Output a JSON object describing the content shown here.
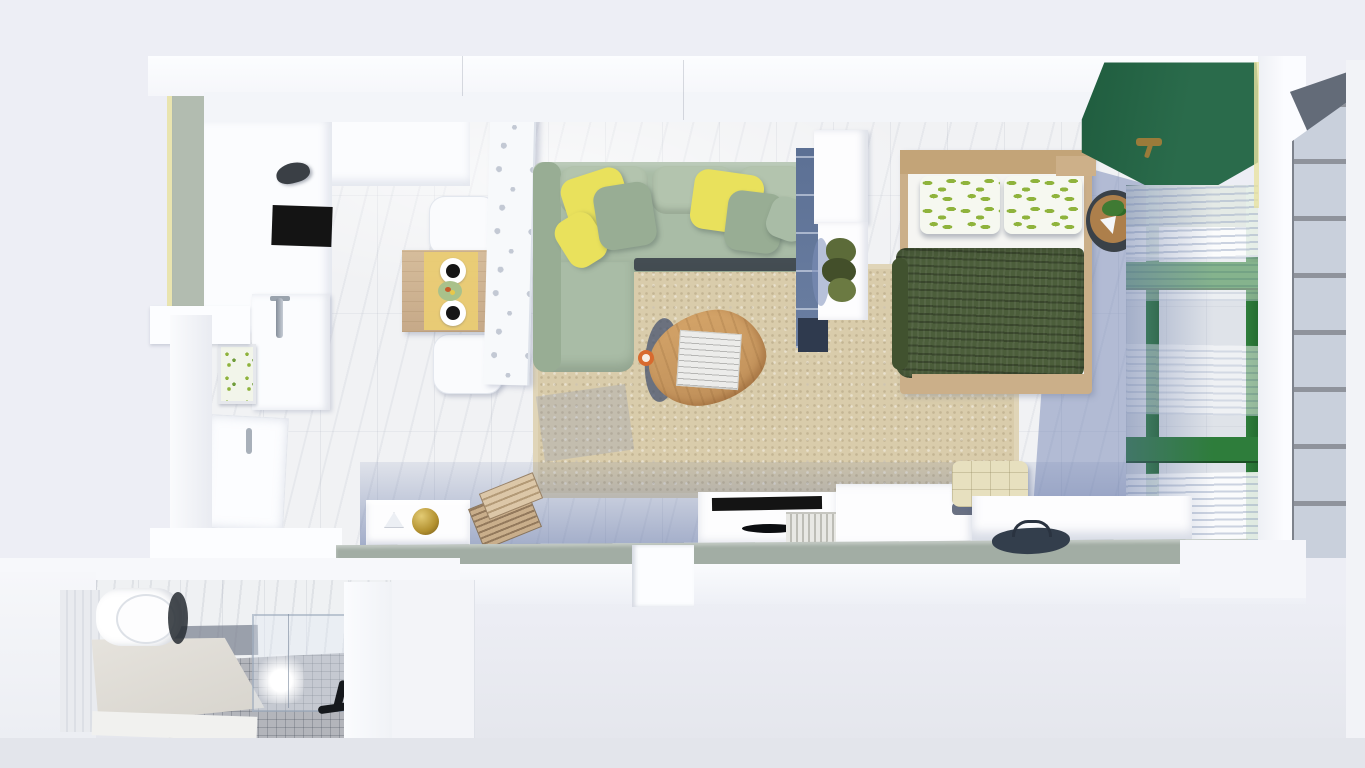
{
  "meta": {
    "title": "3D top-down floor plan render of a studio apartment",
    "width_px": 1365,
    "height_px": 768,
    "view": "top-down-3d-render",
    "visible_text": ""
  },
  "colors": {
    "bg_outer": "#edeef5",
    "bg_bottom": "#e3e5eb",
    "wall_white": "#fcfdff",
    "wall_face": "#f3f5f9",
    "sage_wall": "#b2bcb0",
    "bottom_sage": "#a2ada4",
    "sun_edge": "#e8e2a2",
    "marble_base": "#f1f2f4",
    "counter_white": "#fbfcfe",
    "cooktop_black": "#141414",
    "runner_yellow": "#eacc74",
    "plate_dark": "#161616",
    "bowl_green": "#a9c18b",
    "chair_white": "#fafbfd",
    "divider_white": "#f7f9fb",
    "divider_hole": "#c3c9d4",
    "sofa_green": "#a9bca6",
    "sofa_dark": "#98ad94",
    "cushion_light": "#b3c4ae",
    "pillow_yellow": "#e9e15c",
    "seat_shadow": "#343b45",
    "rug_beige": "#d9ccab",
    "rug_edge": "#e0d5b8",
    "coffee_wood": "#c0905a",
    "coffee_shadow": "#46536f",
    "book_gray": "#ececea",
    "cup_orange": "#d86a2e",
    "shelf_blue": "#5c7094",
    "shelf_dark": "#2f3a4e",
    "console_white": "#fdfdfe",
    "plant_olive": "#5c6b39",
    "bed_wood": "#cbaf89",
    "mattress_white": "#f5f5f2",
    "blanket_green": "#4c5e3b",
    "leaf_green": "#8fb33c",
    "pillow_white": "#f6f8f0",
    "green_wall": "#2a6b4b",
    "brass": "#9a7b3a",
    "window_green": "#2e7d3b",
    "window_dark": "#1d4a2c",
    "curtain_stripe": "#c9d1df",
    "shadow_blue": "#7d90ba",
    "facade_glass": "#c9d0dc",
    "facade_mullion": "#8f939c",
    "facade_dark": "#636b78",
    "gold": "#b2902f",
    "ottoman_cream": "#e7e0bf",
    "bag_dark": "#333e4c",
    "bath_floor": "#b3b5bb",
    "bath_platform": "#d6d3cc",
    "fixture_dark": "#16191d",
    "glass_tint": "rgba(225,235,245,0.38)"
  },
  "scene": {
    "rooms": [
      {
        "name": "kitchen-dining",
        "position": "top-left"
      },
      {
        "name": "living-room",
        "position": "center"
      },
      {
        "name": "bedroom",
        "position": "right"
      },
      {
        "name": "bathroom",
        "position": "bottom-left"
      }
    ],
    "objects": [
      "kitchen-counter-l-shape",
      "cooktop",
      "range-hood",
      "kettle",
      "dining-table",
      "table-runner",
      "plates",
      "fruit-bowl",
      "dining-chairs",
      "perforated-room-divider",
      "sink-cabinet",
      "faucet",
      "botanical-art-frame",
      "entry-door",
      "sectional-sofa",
      "yellow-throw-pillows",
      "sage-throw-pillows",
      "area-rug",
      "oval-coffee-table",
      "open-book",
      "coffee-cup",
      "bookshelf-divider",
      "plant-console",
      "potted-plant",
      "double-bed",
      "leaf-print-pillows",
      "green-blanket",
      "bedside-table",
      "bedside-plant",
      "green-accent-wall",
      "brass-sconce",
      "green-frame-windows",
      "sheer-curtains",
      "exterior-facade-window",
      "low-sideboard",
      "gold-ornament",
      "folding-wood-chair",
      "tv-console",
      "tv",
      "book-stack",
      "storage-cabinet",
      "cream-tufted-ottoman",
      "long-bench",
      "dark-bag",
      "toilet",
      "bath-platform-vanity",
      "shower-glass-enclosure",
      "shower-fixture",
      "mosaic-floor"
    ]
  }
}
